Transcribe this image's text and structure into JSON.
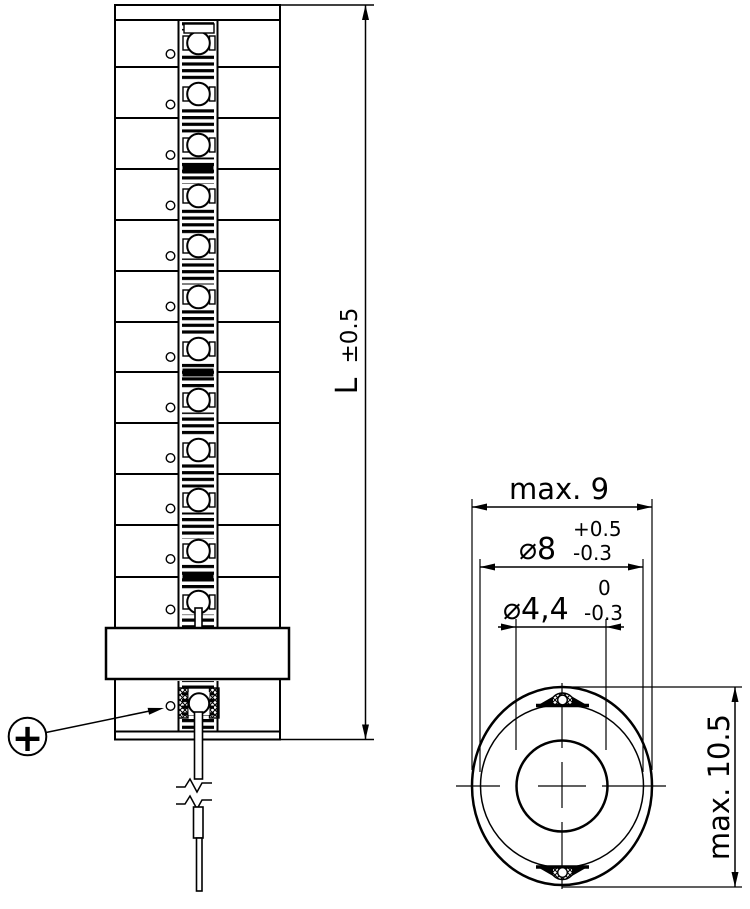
{
  "drawing": {
    "description": "Technical drawing of a tubular ceramic heating element, side elevation with lead wire and end view with diameters",
    "colors": {
      "line": "#000000",
      "background": "#ffffff"
    },
    "front_view": {
      "length_dimension": {
        "label": "L",
        "tolerance": "±0.5"
      },
      "polarity_marker": "+"
    },
    "end_view": {
      "width_dimension": "max. 9",
      "outer_diameter": {
        "value": "⌀8",
        "tol_upper": "+0.5",
        "tol_lower": "-0.3"
      },
      "core_diameter": {
        "value": "⌀4,4",
        "tol_upper": "0",
        "tol_lower": "-0.3"
      },
      "height_dimension": "max. 10.5"
    }
  }
}
